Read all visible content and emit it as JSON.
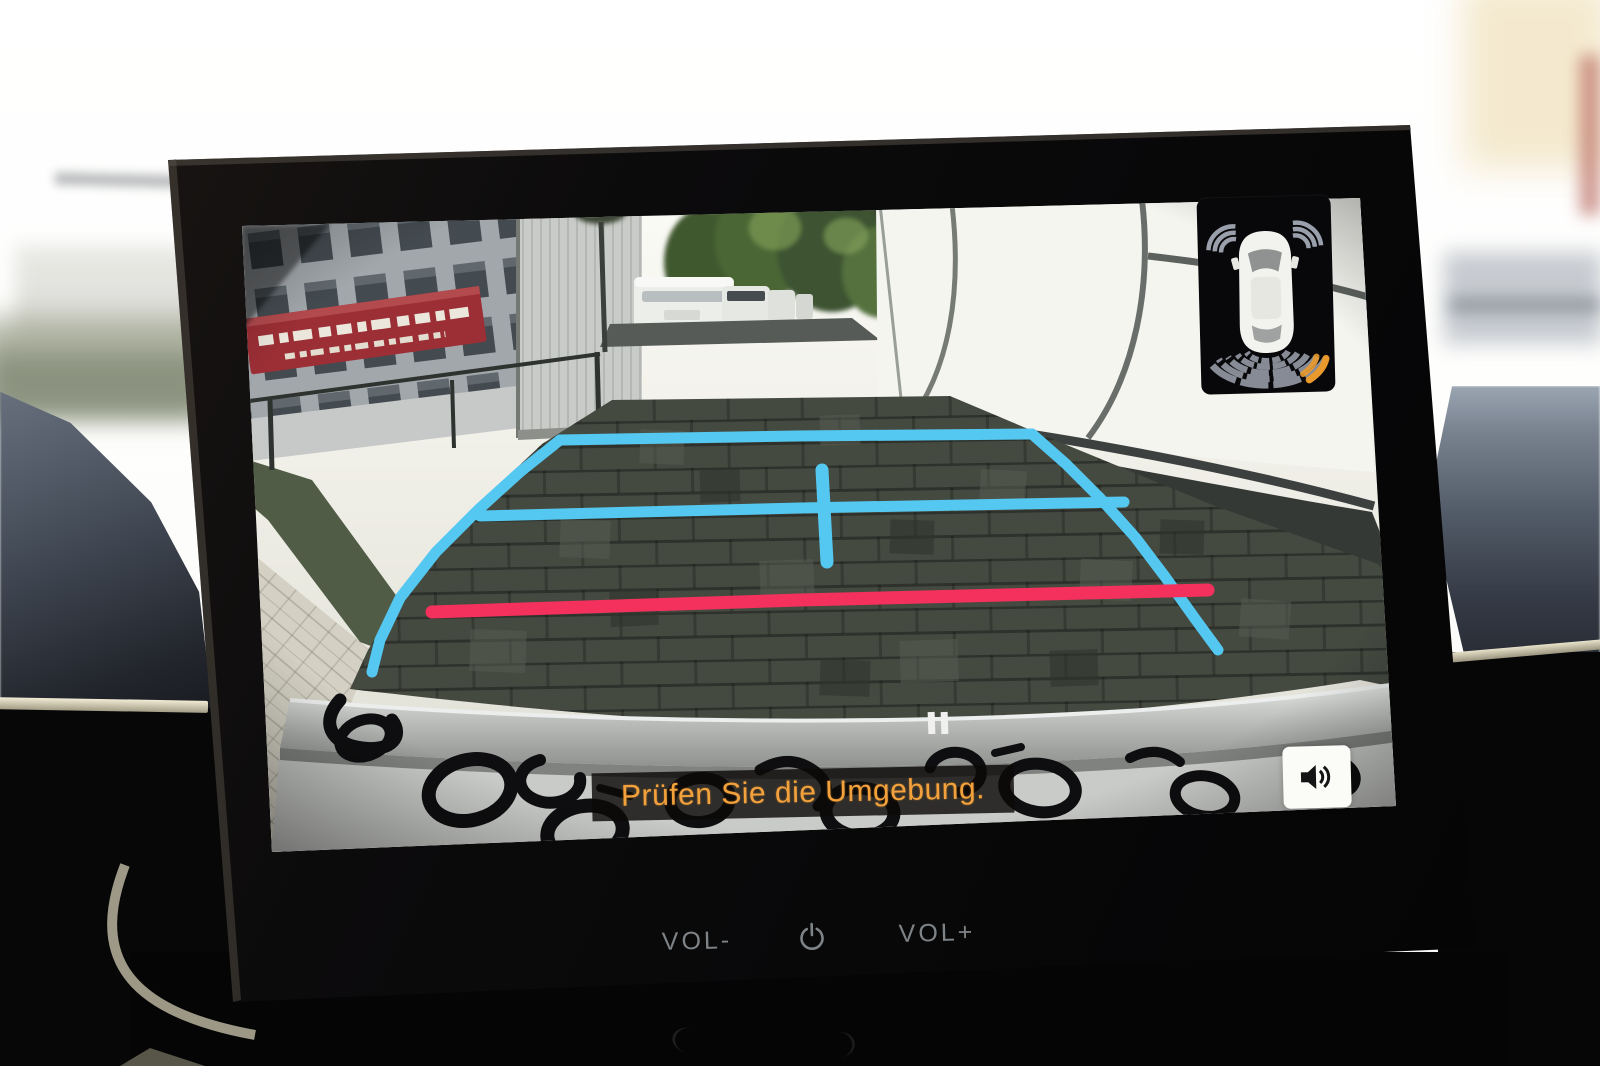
{
  "infotainment": {
    "camera_view": {
      "subtitle": "Prüfen Sie die Umgebung.",
      "scene": "rear-camera-parking-lot-with-guidelines"
    },
    "sensor_widget": {
      "vehicle_icon": "car-top-view",
      "front_sensor_state": "inactive-gray",
      "rear_sensor_state": "active-rear-right",
      "rear_arc_rows": 5
    },
    "audio_button_icon": "speaker-volume",
    "hard_keys": {
      "vol_down": "VOL-",
      "power_icon": "power",
      "vol_up": "VOL+"
    },
    "colors": {
      "guide_line_blue": "#54C8F0",
      "distance_line_red": "#F4315C",
      "subtitle_orange": "#F2A13C",
      "sensor_active_orange": "#EA9A2D",
      "screen_bezel": "#0B0A0C",
      "speaker_button_bg": "#FBFBF8"
    }
  }
}
